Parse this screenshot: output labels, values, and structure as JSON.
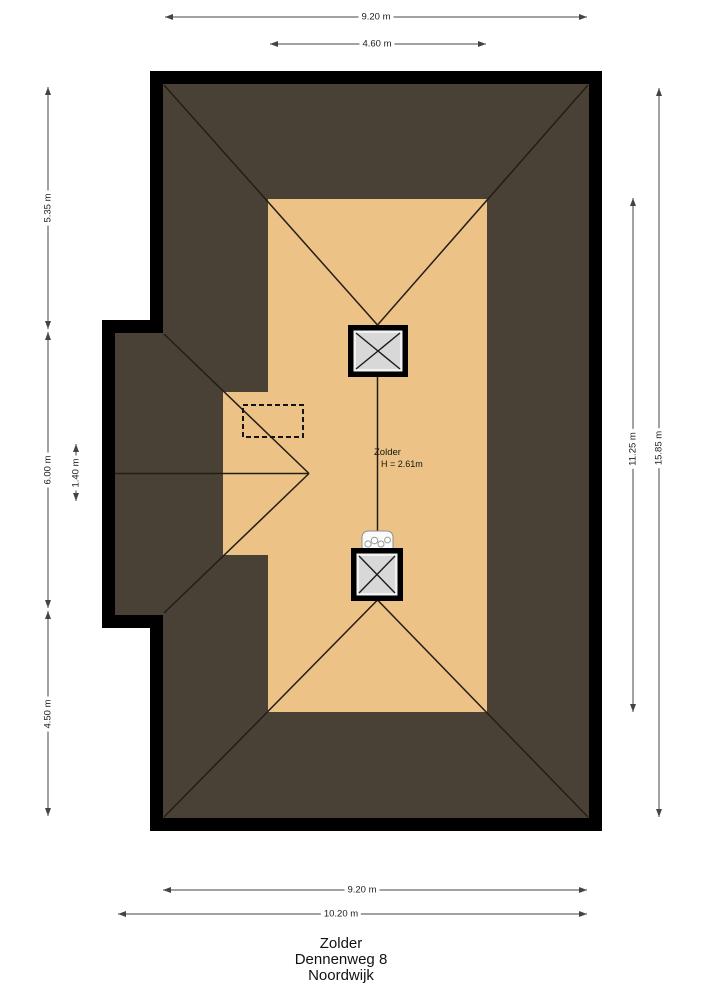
{
  "colors": {
    "background": "#ffffff",
    "wall": "#000000",
    "roof": "#4a4136",
    "floor": "#ecc287",
    "chimney_frame": "#000000",
    "chimney_inner": "#f2f2f2",
    "chimney_fill": "#d8d8d8",
    "ridge_line": "#241d15",
    "dimension_line": "#444444",
    "fixture_stroke": "#8f8f8f",
    "fixture_fill": "#fbfbfb"
  },
  "room_label": {
    "name": "Zolder",
    "height": "H = 2.61m"
  },
  "dimensions": {
    "top_outer": "9.20 m",
    "top_inner": "4.60 m",
    "left_upper": "5.35 m",
    "left_middle": "6.00 m",
    "left_lower": "4.50 m",
    "left_inner": "1.40 m",
    "right_inner": "11.25 m",
    "right_outer": "15.85 m",
    "bottom_inner": "9.20 m",
    "bottom_outer": "10.20 m"
  },
  "title_block": {
    "room": "Zolder",
    "address": "Dennenweg 8",
    "city": "Noordwijk"
  }
}
